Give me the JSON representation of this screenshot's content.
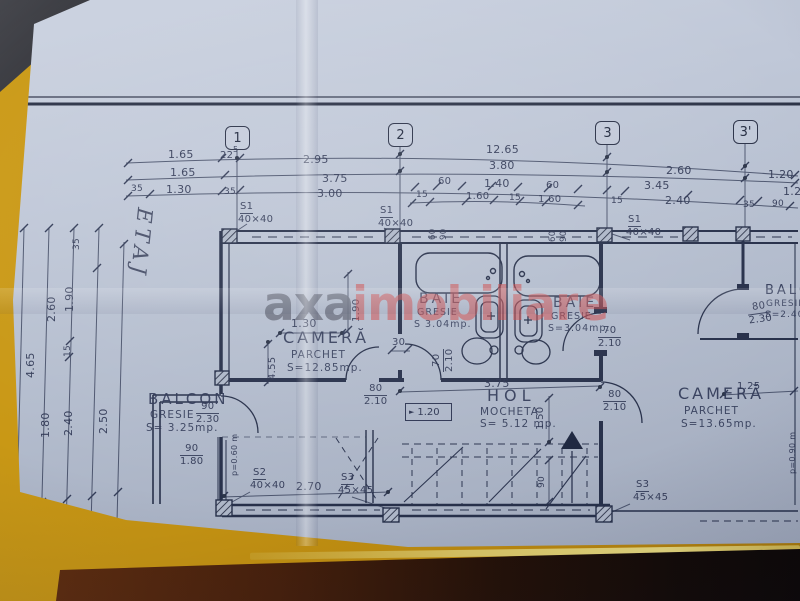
{
  "colors": {
    "paper": "#b9c1d2",
    "ink": "#2b3248",
    "table_yellow": "#c49612",
    "watermark_red": "#cd4a4b",
    "band_dark": "#3d1709"
  },
  "watermark": {
    "axa": "axa",
    "imobiliare": "imobiliare"
  },
  "etaj": "ETAJ",
  "grid": {
    "b1": "1",
    "b2": "2",
    "b3": "3",
    "b3p": "3'"
  },
  "top": {
    "t165a": "1.65",
    "t22": "22",
    "t5": "5",
    "t295": "2.95",
    "t1265": "12.65",
    "t260": "2.60",
    "t120": "1.20",
    "t165b": "1.65",
    "t375": "3.75",
    "t380": "3.80",
    "t345": "3.45",
    "t125": "1.25",
    "t35a": "35",
    "t130": "1.30",
    "t35b": "35",
    "t300": "3.00",
    "t60a": "60",
    "t140": "1.40",
    "t60b": "60",
    "t240": "2.40",
    "t15r": "15",
    "t35r": "35",
    "t90r": "90",
    "t15a": "15",
    "t160a": "1.60",
    "t15b": "15",
    "t160b": "1.60"
  },
  "left": {
    "l465": "4.65",
    "l260": "2.60",
    "l190": "1.90",
    "l35t": "35",
    "l15": "15",
    "l180": "1.80",
    "l240": "2.40",
    "l250": "2.50",
    "l35b": "35",
    "l140": "1.40"
  },
  "win": {
    "s1": "S1",
    "s1s": "40×40",
    "s2": "S2",
    "s2s": "40×40",
    "s3": "S3",
    "s3s": "45×45",
    "w60": "60",
    "w90": "90"
  },
  "rooms": {
    "camera1": {
      "name": "CAMERĂ",
      "finish": "PARCHET",
      "area": "S=12.85mp."
    },
    "baie1": {
      "name": "BAIE",
      "finish": "GRESIE",
      "area": "S 3.04mp."
    },
    "baie2": {
      "name": "BAIE",
      "finish": "GRESIE",
      "area": "S=3.04mp."
    },
    "camera2": {
      "name": "CAMERĂ",
      "finish": "PARCHET",
      "area": "S=13.65mp."
    },
    "balcon1": {
      "name": "BALCON",
      "finish": "GRESIE",
      "area": "S= 3.25mp."
    },
    "balcon2": {
      "name": "BALCON",
      "finish": "GRESIE",
      "area": "S=2.40m"
    },
    "hol": {
      "name": "HOL",
      "finish": "MOCHETA",
      "area": "S= 5.12 mp."
    }
  },
  "doors": {
    "d1t": "90",
    "d1b": "2.30",
    "d2t": "90",
    "d2b": "1.80",
    "d3t": "80",
    "d3b": "2.10",
    "d4t": "70",
    "d4b": "2.10",
    "d5t": "70",
    "d5b": "2.10",
    "d6t": "80",
    "d6b": "2.10",
    "d7t": "80",
    "d7b": "2.30"
  },
  "inner": {
    "i130": "1.30",
    "i30": "30",
    "i455": "4.55",
    "i190": "1.90",
    "i375": "3.75",
    "i150": "1.50",
    "i90": "90",
    "i270": "2.70",
    "i125": "1.25",
    "p060": "p=0.60 m",
    "p090": "p=0.90 m"
  },
  "level": {
    "arrow": "►",
    "value": "1.20"
  }
}
